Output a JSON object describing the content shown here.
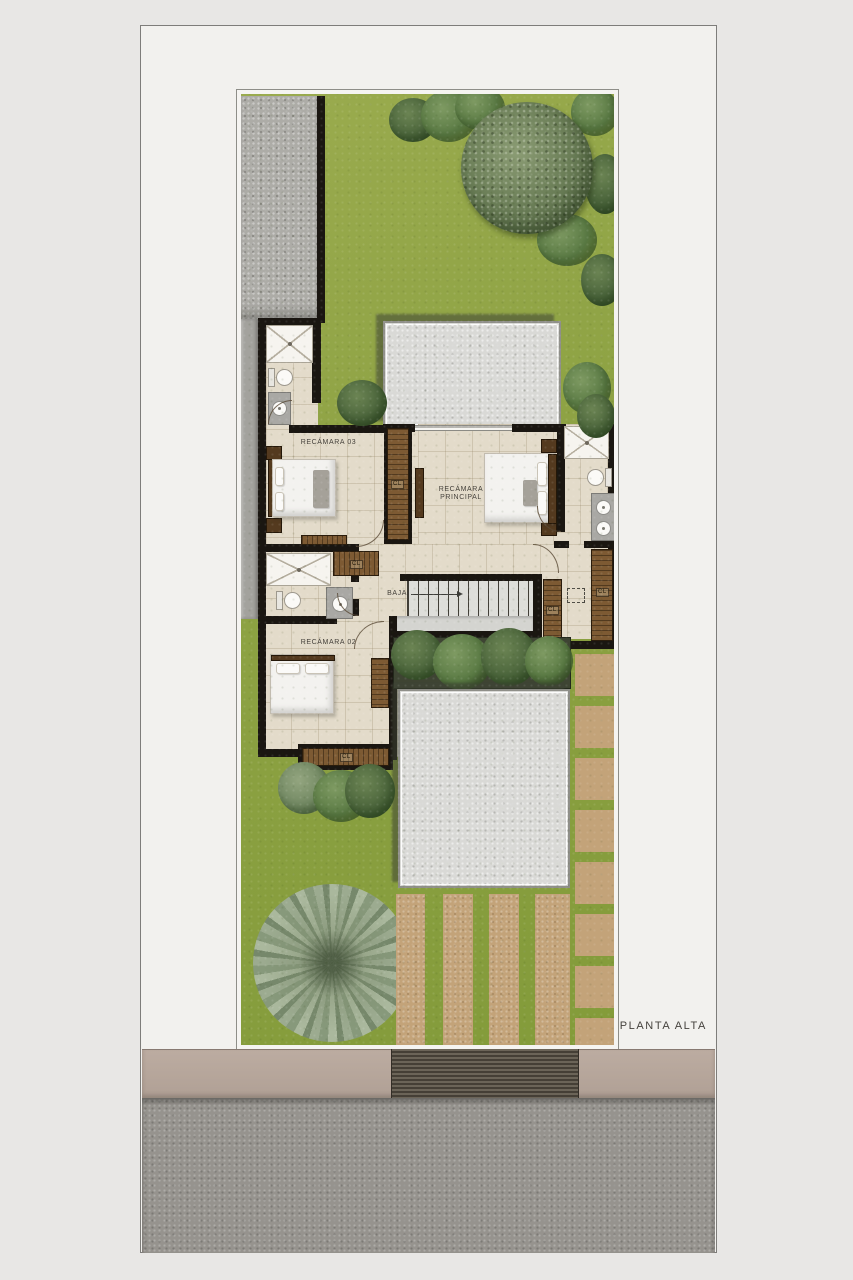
{
  "document": {
    "title": "PLANTA ALTA"
  },
  "plan": {
    "labels": {
      "bedroom3": "RECÁMARA 03",
      "master_line1": "RECÁMARA",
      "master_line2": "PRINCIPAL",
      "bedroom2": "RECÁMARA 02",
      "stairs_down": "BAJA",
      "closet": "CL"
    },
    "colors": {
      "page": "#e8e7e5",
      "sheet": "#f2f1ee",
      "grass": "#8da243",
      "floor": "#e3dbca",
      "wall": "#1a1611",
      "wood": "#7d5a33",
      "wood-dark": "#543a1f",
      "skylight": "#d9d9d6",
      "concrete": "#adaca7",
      "fixture": "#f6f4ef",
      "counter": "#a9a8a4",
      "paver": "#c3a379",
      "sidewalk": "#b5a59a",
      "apron": "#565047",
      "street": "#96938e",
      "text": "#44403a"
    }
  }
}
